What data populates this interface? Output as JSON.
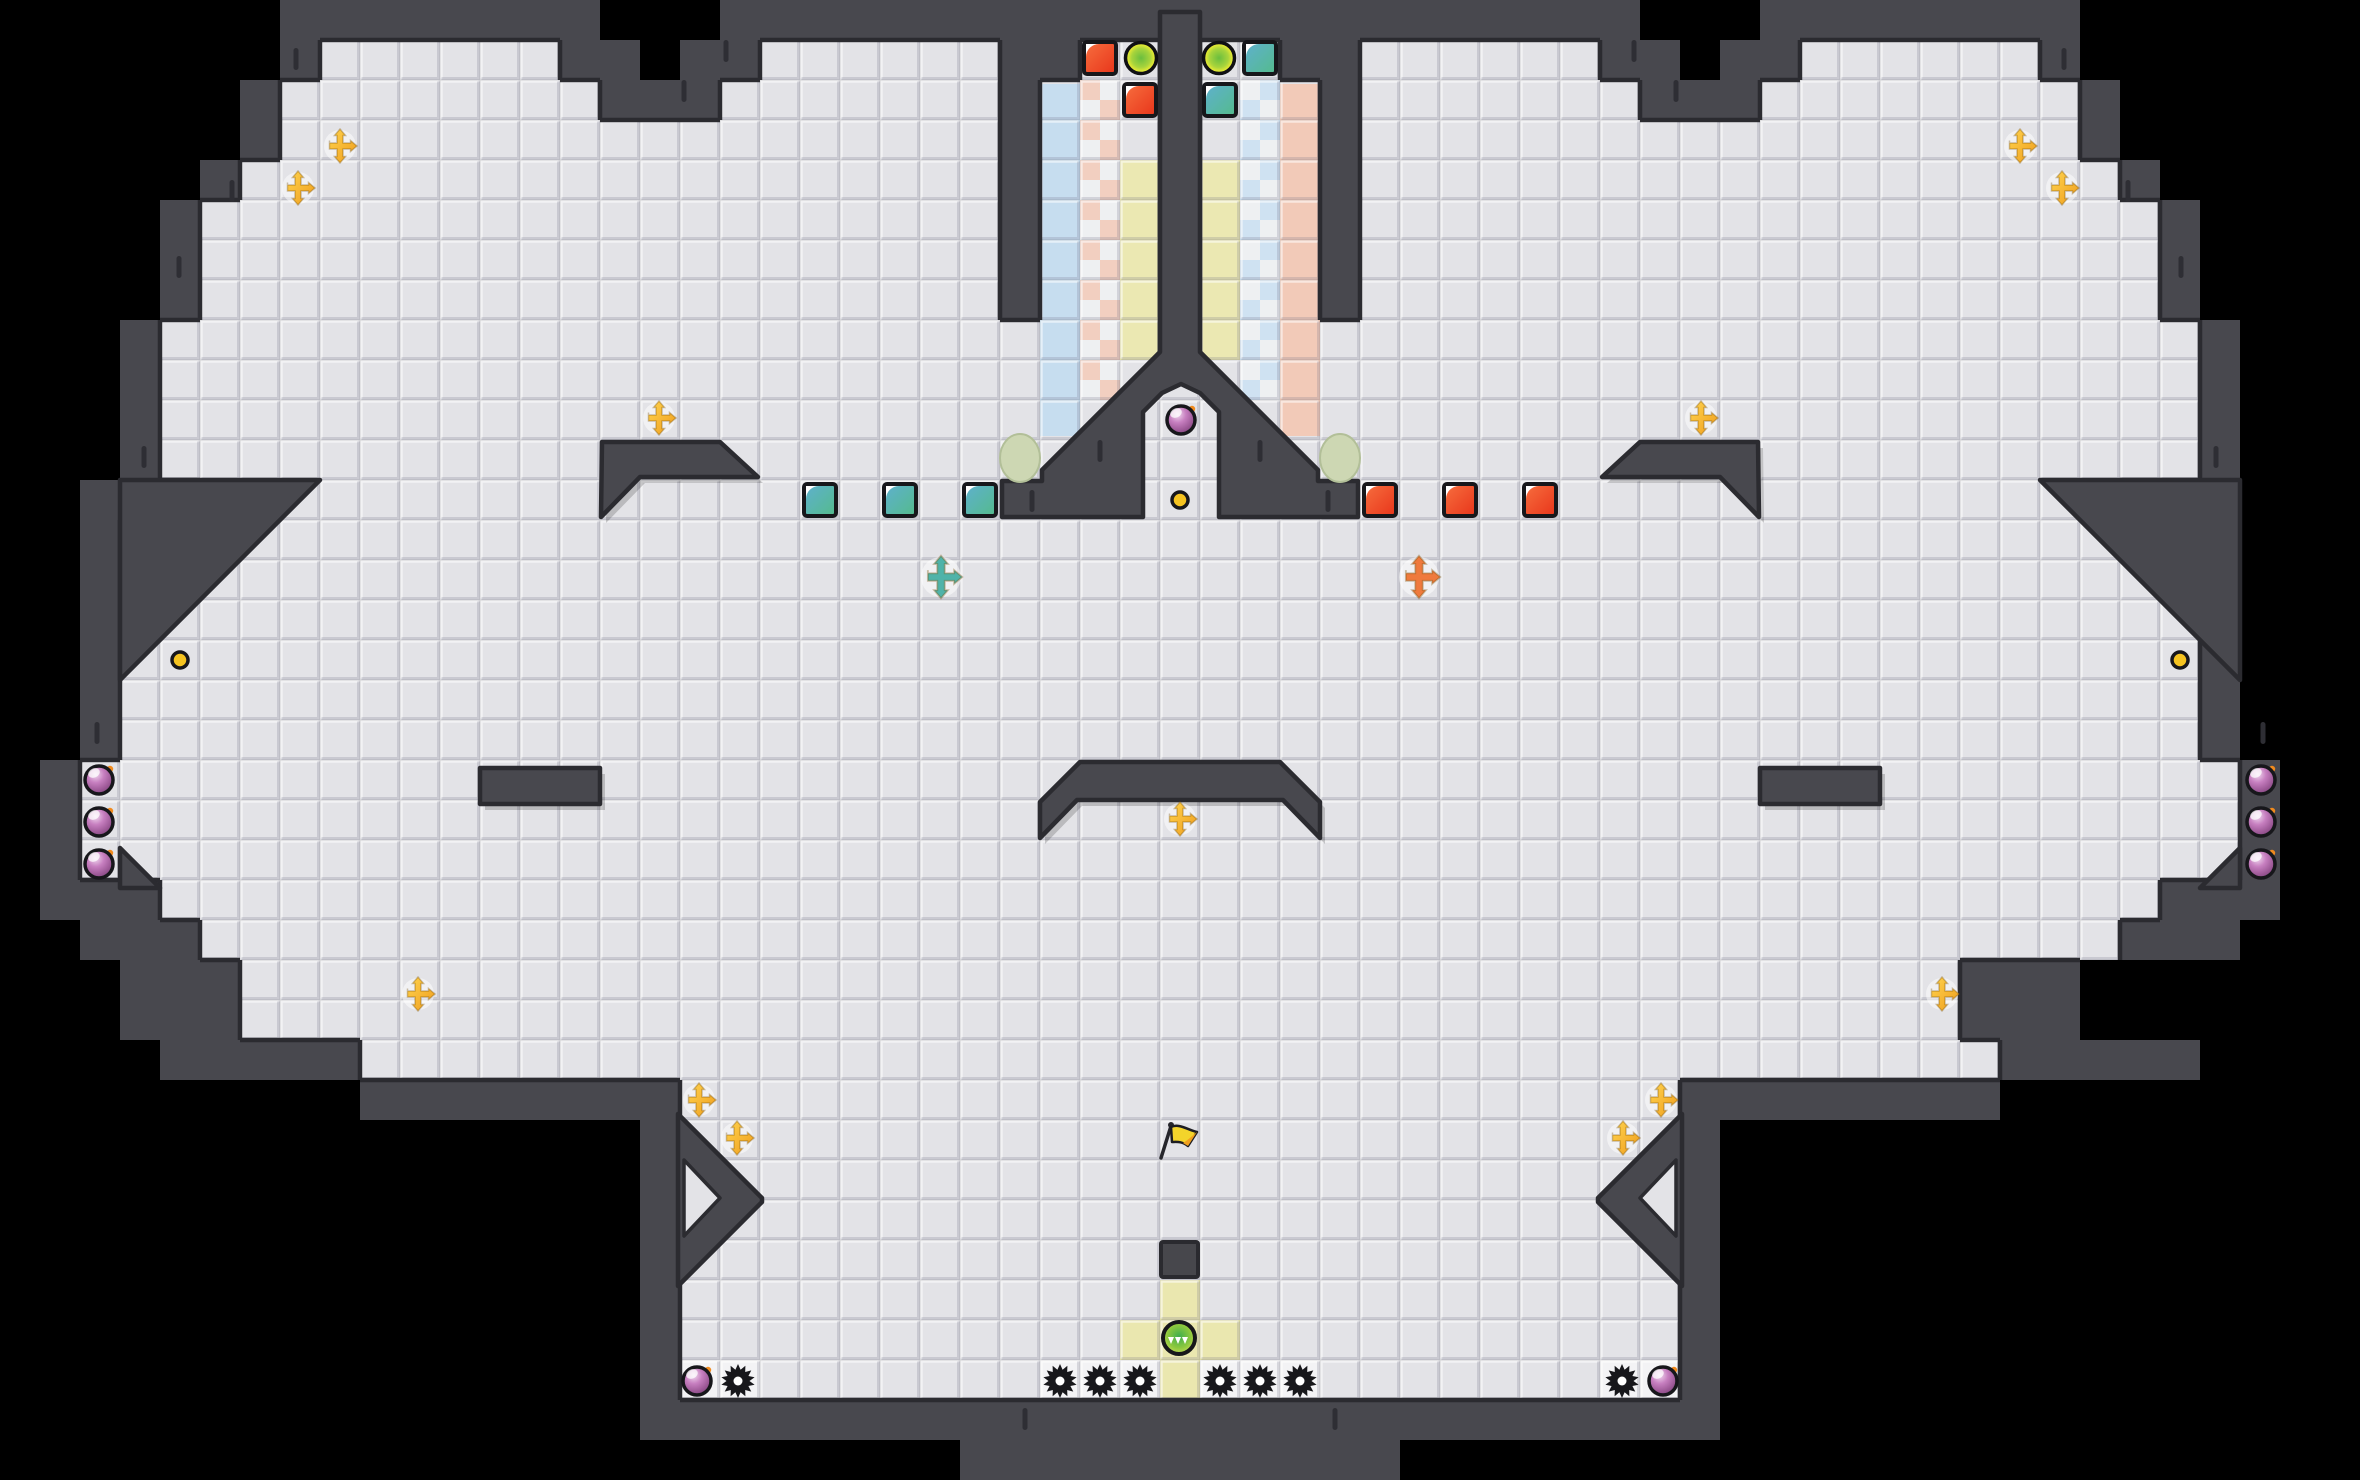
{
  "scene": {
    "width": 2360,
    "height": 1480,
    "tile": 40
  },
  "colors": {
    "void": "#000000",
    "wall": "#48484e",
    "floor": "#e3e3e7",
    "edge": "#2b2b30",
    "crack": "#2e2e34",
    "ink": "#17171b",
    "coin": "#f5c320",
    "pad_yellow": "#eae7af",
    "strip_tile": "#f3f3f5",
    "col_blue": "#c6ddef",
    "col_pink": "#f2cab8",
    "col_yellow": "#ebe8b2",
    "ck_base": "#eef0f2",
    "ck_pink": "#f2cfc0",
    "ck_blue": "#cfe2f2",
    "oval": "#cdd7b3",
    "oval_edge": "#b2bf98",
    "gold1": "#ffd34e",
    "gold2": "#ef9c1c",
    "red1": "#f7703f",
    "red2": "#e8341a",
    "teal1": "#5fb0d0",
    "teal2": "#54bb8b",
    "orb1": "#6abe3e",
    "orb2": "#a8d43c",
    "orb3": "#e6ea34",
    "bomb1": "#f0d9ef",
    "bomb2": "#c77fc0",
    "bomb3": "#9a5694",
    "bomb4": "#6f3f70",
    "spark": "#f08a1e",
    "player1": "#3fae4f",
    "player2": "#8cc83e",
    "player3": "#cfe05a",
    "cross_teal": "#4fb3a9",
    "cross_orange": "#ef7a3d",
    "flag_yellow": "#f3d42b",
    "flag_orange": "#f0a01e",
    "crate": "#47474c",
    "crate_edge": "#2a2a2f"
  },
  "tilemap": {
    "row_defs": {
      "t0": "BBBBBBBWWWWWWWWBBBWWWWWWWWWWWWWWWWWWWWWWWBBBWWWWWWWWBBBBBBB",
      "t1": "BBBBBBBWFFFFFFWWBWWFFFFFFWWFFWFFWWFFFFFFWWBWWFFFFFFWBBBBBBB",
      "t2": "BBBBBBWFFFFFFFFWWWFFFFFFFWFFFWFFFWFFFFFFFWWWFFFFFFFFWBBBBBB",
      "t3": "BBBBBBWFFFFFFFFFFFFFFFFFFWFFFWFFFWFFFFFFFFFFFFFFFFFFWBBBBBB",
      "t4": "BBBBBWFFFFFFFFFFFFFFFFFFFWFFFWFFFWFFFFFFFFFFFFFFFFFFFWBBBBB",
      "t5": "BBBBWFFFFFFFFFFFFFFFFFFFFWFFFWFFFWFFFFFFFFFFFFFFFFFFFFWBBBB",
      "t8": "BBBWFFFFFFFFFFFFFFFFFFFFFFFFFWFFFFFFFFFFFFFFFFFFFFFFFFFWBBB",
      "t9": "BBBWFFFFFFFFFFFFFFFFFFFFFFFFFFFFFFFFFFFFFFFFFFFFFFFFFFFWBBB",
      "t12": "BBWWWFFFFFFFFFFFFFFFFFFFFFFFFFFFFFFFFFFFFFFFFFFFFFFFFWWWBB",
      "t13": "BBWFFFFFFFFFFFFFFFFFFFFFFFFFFFFFFFFFFFFFFFFFFFFFFFFFFFFWBB",
      "t19": "BWFFFFFFFFFFFFFFFFFFFFFFFFFFFFFFFFFFFFFFFFFFFFFFFFFFFFFFWB",
      "t22": "BWWWFFFFFFFFFFFFFFFFFFFFFFFFFFFFFFFFFFFFFFFFFFFFFFFFFFWWWB",
      "t24": "BBBWWWFFFFFFFFFFFFFFFFFFFFFFFFFFFFFFFFFFFFFFFFFFFWWWBBB",
      "t26": "BBBBWWWWWFFFFFFFFFFFFFFFFFFFFFFFFFFFFFFFFFFFFFFFFFWWWWWBBBB",
      "t27": "BBBBBBBBBWWWWWWWWFFFFFFFFFFFFFFFFFFFFFFFFFWWWWWWWWBBBBBBBBB",
      "t28": "BBBBBBBBBBBBBBBBWFFFFFFFFFFFFFFFFFFFFFFFFFWBBBBBBBBBBBBBBBB",
      "t35": "BBBBBBBBBBBBBBBBWWWWWWWWWWWWWWWWWWWWWWWWWWWBBBBBBBBBBBBBBBB",
      "t36": "BBBBBBBBBBBBBBBBBBBBBBBBWWWWWWWWWWWBBBBBBBBBBBBBBBBBBBBBBBB"
    },
    "row_order": [
      "t0",
      "t1",
      "t2",
      "t3",
      "t4",
      "t5",
      "t5",
      "t5",
      "t8",
      "t9",
      "t9",
      "t9",
      "t12",
      "t13",
      "t13",
      "t13",
      "t13",
      "t13",
      "t13",
      "t19",
      "t19",
      "t19",
      "t22",
      "t12",
      "t24",
      "t24",
      "t26",
      "t27",
      "t28",
      "t28",
      "t28",
      "t28",
      "t28",
      "t28",
      "t28",
      "t35",
      "t36"
    ]
  },
  "overlays": {
    "columns": [
      {
        "name": "door-column-blue-solid",
        "x": 1040,
        "y": 84,
        "w": 40,
        "h": 352,
        "fill": "col_blue"
      },
      {
        "name": "door-column-pink-checker",
        "x": 1080,
        "y": 80,
        "w": 40,
        "h": 320,
        "checker": "pink"
      },
      {
        "name": "door-column-yellow-left",
        "x": 1120,
        "y": 160,
        "w": 40,
        "h": 200,
        "fill": "col_yellow"
      },
      {
        "name": "door-column-yellow-right",
        "x": 1200,
        "y": 160,
        "w": 40,
        "h": 200,
        "fill": "col_yellow"
      },
      {
        "name": "door-column-blue-checker",
        "x": 1240,
        "y": 80,
        "w": 40,
        "h": 320,
        "checker": "blue"
      },
      {
        "name": "door-column-pink-solid",
        "x": 1280,
        "y": 84,
        "w": 40,
        "h": 352,
        "fill": "col_pink"
      }
    ],
    "yellow_tiles": [
      [
        29,
        32
      ],
      [
        28,
        33
      ],
      [
        29,
        33
      ],
      [
        30,
        33
      ],
      [
        29,
        34
      ]
    ],
    "light_tiles": [
      [
        17,
        34
      ],
      [
        18,
        34
      ],
      [
        26,
        34
      ],
      [
        27,
        34
      ],
      [
        28,
        34
      ],
      [
        30,
        34
      ],
      [
        31,
        34
      ],
      [
        32,
        34
      ],
      [
        40,
        34
      ],
      [
        41,
        34
      ]
    ],
    "wall_polys": [
      {
        "name": "center-mound-wall",
        "pts": [
          [
            1160,
            12
          ],
          [
            1200,
            12
          ],
          [
            1200,
            352
          ],
          [
            1318,
            470
          ],
          [
            1318,
            481
          ],
          [
            1358,
            481
          ],
          [
            1358,
            517
          ],
          [
            1219,
            517
          ],
          [
            1219,
            412
          ],
          [
            1200,
            393
          ],
          [
            1181,
            384
          ],
          [
            1162,
            393
          ],
          [
            1143,
            412
          ],
          [
            1143,
            517
          ],
          [
            1002,
            517
          ],
          [
            1002,
            481
          ],
          [
            1042,
            481
          ],
          [
            1042,
            470
          ],
          [
            1160,
            352
          ]
        ]
      },
      {
        "name": "center-bridge-wall",
        "shadow": true,
        "pts": [
          [
            1080,
            762
          ],
          [
            1280,
            762
          ],
          [
            1320,
            802
          ],
          [
            1320,
            838
          ],
          [
            1283,
            800
          ],
          [
            1077,
            800
          ],
          [
            1040,
            838
          ],
          [
            1040,
            802
          ]
        ]
      },
      {
        "name": "left-bar-wall",
        "shadow": true,
        "pts": [
          [
            480,
            768
          ],
          [
            600,
            768
          ],
          [
            600,
            804
          ],
          [
            480,
            804
          ]
        ]
      },
      {
        "name": "right-bar-wall",
        "shadow": true,
        "pts": [
          [
            1760,
            768
          ],
          [
            1880,
            768
          ],
          [
            1880,
            804
          ],
          [
            1760,
            804
          ]
        ]
      },
      {
        "name": "left-eyebrow-wall",
        "shadow": true,
        "pts": [
          [
            602,
            442
          ],
          [
            720,
            442
          ],
          [
            758,
            477
          ],
          [
            640,
            477
          ],
          [
            601,
            517
          ]
        ]
      },
      {
        "name": "right-eyebrow-wall",
        "shadow": true,
        "pts": [
          [
            1758,
            442
          ],
          [
            1640,
            442
          ],
          [
            1602,
            477
          ],
          [
            1720,
            477
          ],
          [
            1759,
            517
          ]
        ]
      },
      {
        "name": "left-slope-wedge",
        "pts": [
          [
            320,
            480
          ],
          [
            120,
            680
          ],
          [
            120,
            480
          ]
        ]
      },
      {
        "name": "right-slope-wedge",
        "pts": [
          [
            2040,
            480
          ],
          [
            2240,
            680
          ],
          [
            2240,
            480
          ]
        ]
      },
      {
        "name": "left-pocket-slope",
        "pts": [
          [
            120,
            848
          ],
          [
            160,
            888
          ],
          [
            120,
            888
          ]
        ]
      },
      {
        "name": "right-pocket-slope",
        "pts": [
          [
            2240,
            848
          ],
          [
            2200,
            888
          ],
          [
            2240,
            888
          ]
        ]
      },
      {
        "name": "left-arrow-bulge",
        "pts": [
          [
            678,
            1114
          ],
          [
            762,
            1198
          ],
          [
            762,
            1202
          ],
          [
            678,
            1286
          ]
        ]
      },
      {
        "name": "right-arrow-bulge",
        "pts": [
          [
            1682,
            1114
          ],
          [
            1598,
            1198
          ],
          [
            1598,
            1202
          ],
          [
            1682,
            1286
          ]
        ]
      }
    ],
    "floor_polys": [
      {
        "name": "left-triangle-pocket",
        "pts": [
          [
            684,
            1160
          ],
          [
            720,
            1198
          ],
          [
            684,
            1236
          ]
        ]
      },
      {
        "name": "right-triangle-pocket",
        "pts": [
          [
            1676,
            1160
          ],
          [
            1640,
            1198
          ],
          [
            1676,
            1236
          ]
        ]
      }
    ],
    "cracks": [
      [
        296,
        48
      ],
      [
        726,
        40
      ],
      [
        684,
        80
      ],
      [
        232,
        180
      ],
      [
        179,
        256
      ],
      [
        144,
        446
      ],
      [
        1100,
        440
      ],
      [
        1032,
        490
      ],
      [
        97,
        722
      ],
      [
        1335,
        1408
      ],
      [
        2064,
        48
      ],
      [
        1634,
        40
      ],
      [
        1676,
        80
      ],
      [
        2128,
        180
      ],
      [
        2181,
        256
      ],
      [
        2216,
        446
      ],
      [
        1260,
        440
      ],
      [
        1328,
        490
      ],
      [
        2263,
        722
      ],
      [
        1025,
        1408
      ]
    ]
  },
  "objects": {
    "golds": [
      [
        340,
        146
      ],
      [
        298,
        188
      ],
      [
        2020,
        146
      ],
      [
        2062,
        188
      ],
      [
        659,
        418
      ],
      [
        1701,
        418
      ],
      [
        1180,
        819
      ],
      [
        418,
        994
      ],
      [
        1942,
        994
      ],
      [
        699,
        1100
      ],
      [
        737,
        1138
      ],
      [
        1661,
        1100
      ],
      [
        1623,
        1138
      ]
    ],
    "special_crosses": [
      {
        "x": 941,
        "y": 577,
        "color": "cross_teal"
      },
      {
        "x": 1419,
        "y": 577,
        "color": "cross_orange"
      }
    ],
    "coins": [
      [
        180,
        660
      ],
      [
        1180,
        500
      ],
      [
        2180,
        660
      ]
    ],
    "bombs": [
      [
        99,
        780
      ],
      [
        99,
        822
      ],
      [
        99,
        864
      ],
      [
        2261,
        780
      ],
      [
        2261,
        822
      ],
      [
        2261,
        864
      ],
      [
        1181,
        420
      ],
      [
        697,
        1381
      ],
      [
        1663,
        1381
      ]
    ],
    "gears": [
      [
        738,
        1381
      ],
      [
        1060,
        1381
      ],
      [
        1100,
        1381
      ],
      [
        1140,
        1381
      ],
      [
        1220,
        1381
      ],
      [
        1260,
        1381
      ],
      [
        1300,
        1381
      ],
      [
        1622,
        1381
      ]
    ],
    "blocks": [
      {
        "x": 1100,
        "y": 58,
        "type": "red"
      },
      {
        "x": 1140,
        "y": 100,
        "type": "red"
      },
      {
        "x": 1380,
        "y": 500,
        "type": "red"
      },
      {
        "x": 1460,
        "y": 500,
        "type": "red"
      },
      {
        "x": 1540,
        "y": 500,
        "type": "red"
      },
      {
        "x": 1260,
        "y": 58,
        "type": "teal"
      },
      {
        "x": 1220,
        "y": 100,
        "type": "teal"
      },
      {
        "x": 820,
        "y": 500,
        "type": "teal"
      },
      {
        "x": 900,
        "y": 500,
        "type": "teal"
      },
      {
        "x": 980,
        "y": 500,
        "type": "teal"
      }
    ],
    "exit_orbs": [
      [
        1141,
        58
      ],
      [
        1219,
        58
      ]
    ],
    "ovals": [
      [
        1020,
        458
      ],
      [
        1340,
        458
      ]
    ],
    "flag": {
      "x": 1161,
      "y": 1158
    },
    "player": {
      "x": 1179,
      "y": 1338
    },
    "crate": {
      "x": 1161,
      "y": 1242,
      "w": 37,
      "h": 35
    }
  }
}
